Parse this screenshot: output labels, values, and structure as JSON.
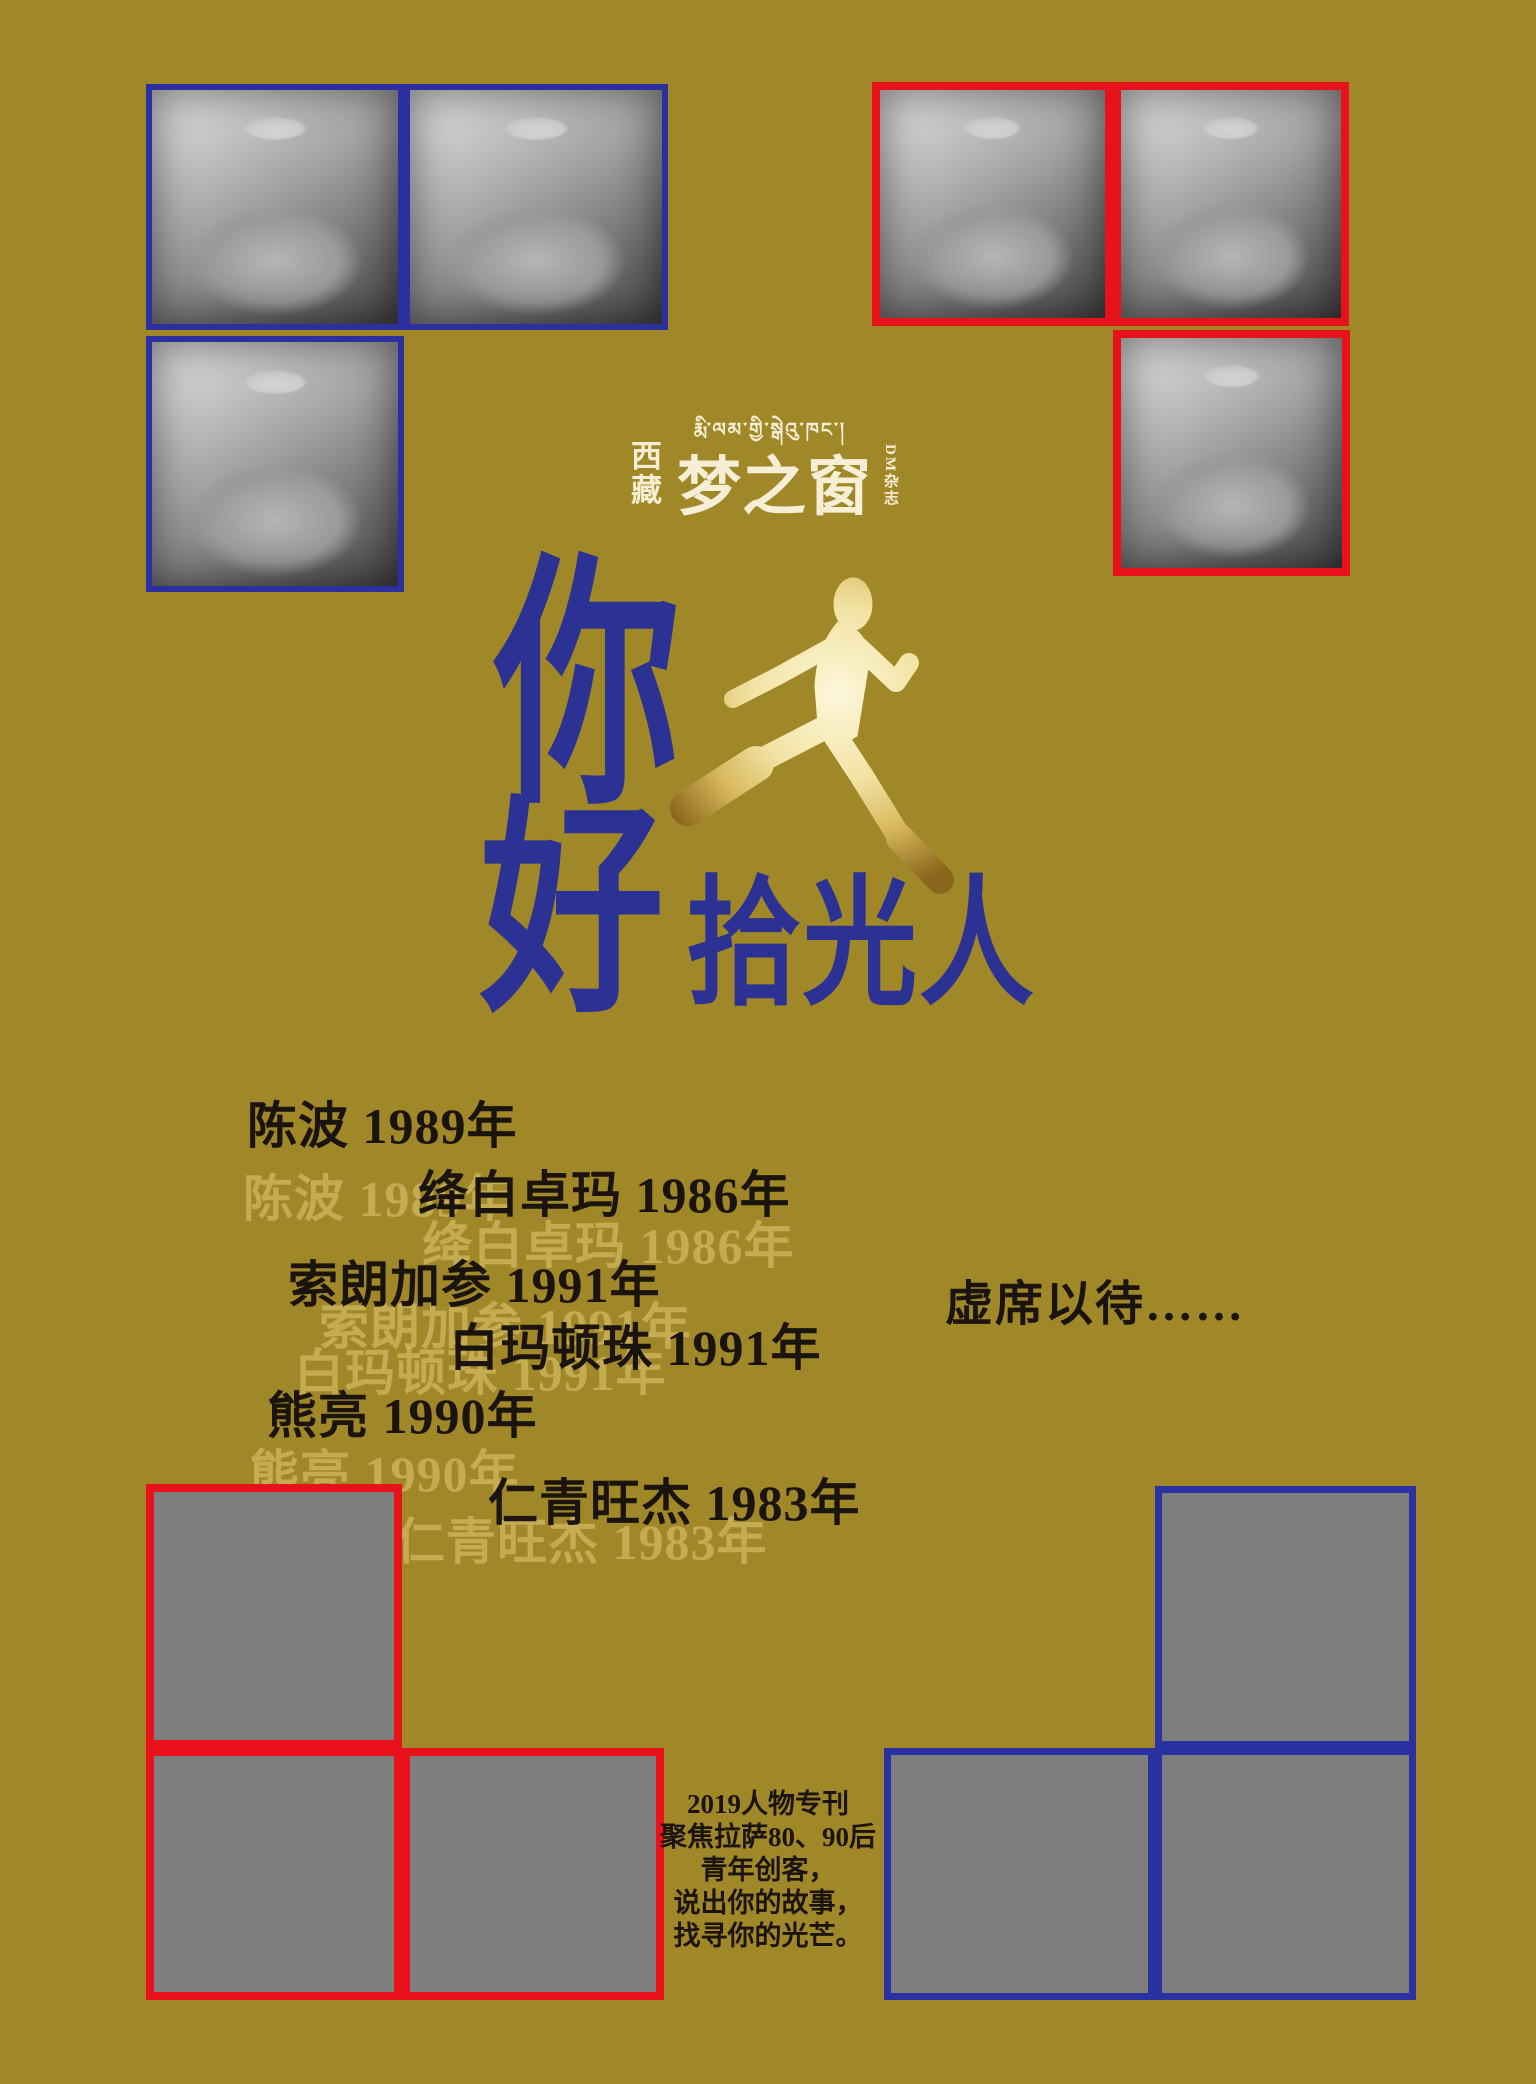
{
  "palette": {
    "background": "#a08728",
    "headline_blue": "#2b3294",
    "photo_border_blue": "#2b2fa0",
    "photo_border_red": "#e8111c",
    "slot_border_red": "#e8111c",
    "slot_border_blue": "#2a31a0",
    "placeholder_gray": "#7e7e7e",
    "ink": "#1a140c",
    "ghost_text": "rgba(228,203,118,0.55)",
    "masthead_cream": "#f7eed6",
    "runner_gold_light": "#fdf7da",
    "runner_gold_dark": "#8a671c"
  },
  "masthead": {
    "tibetan_script": "རྨི་ལམ་གྱི་སྒེའུ་ཁང་།",
    "region_stacked": "西藏",
    "magazine_title": "梦之窗",
    "edition_stacked": "DM杂志"
  },
  "headline": {
    "char_top": "你",
    "char_bottom": "好",
    "tail": "拾光人"
  },
  "icons": {
    "runner": "running-man-galaxy-silhouette"
  },
  "roster": [
    {
      "label": "陈波 1989年"
    },
    {
      "label": "绛白卓玛 1986年"
    },
    {
      "label": "索朗加参 1991年"
    },
    {
      "label": "白玛顿珠 1991年"
    },
    {
      "label": "熊亮 1990年"
    },
    {
      "label": "仁青旺杰 1983年"
    }
  ],
  "vacancy_note": "虚席以待……",
  "footer_blurb": {
    "lines": [
      "2019人物专刊",
      "聚焦拉萨80、90后",
      "青年创客，",
      "说出你的故事，",
      "找寻你的光芒。"
    ]
  }
}
